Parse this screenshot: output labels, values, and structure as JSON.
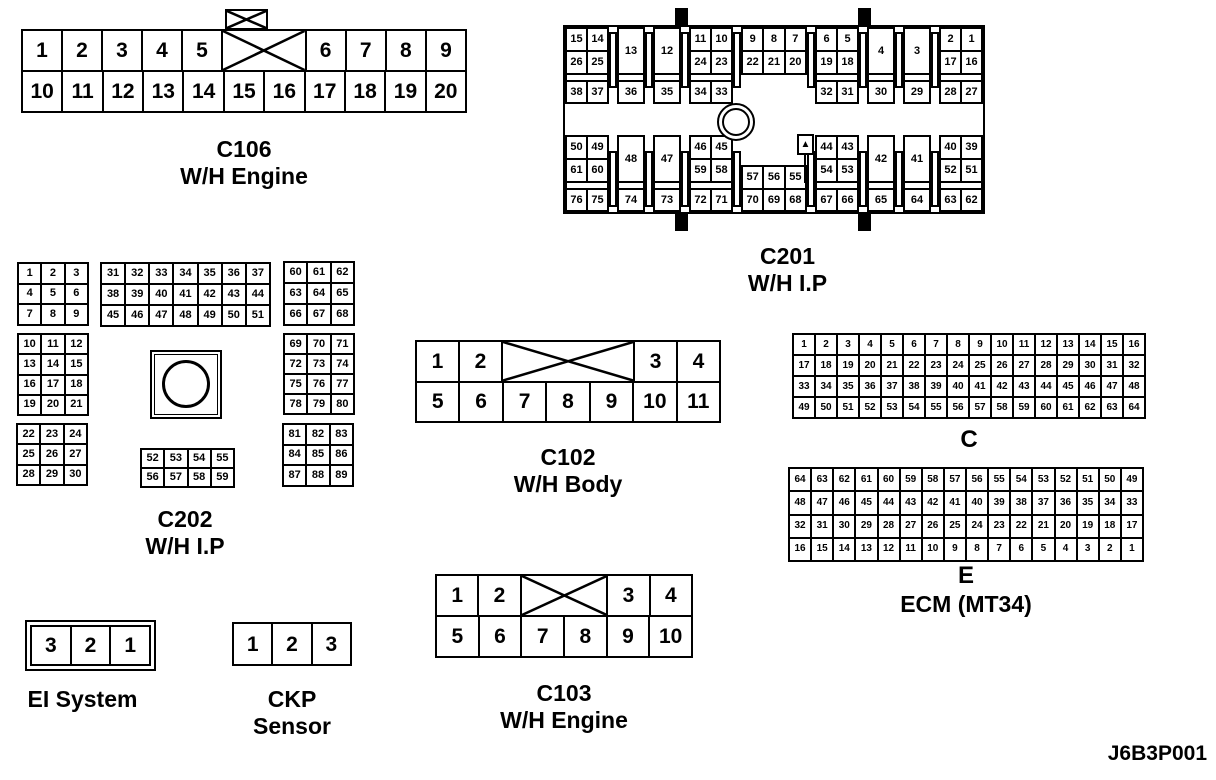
{
  "figure_code": "J6B3P001",
  "ecm_label": "ECM (MT34)",
  "connectors": {
    "c106": {
      "label": "C106",
      "sublabel": "W/H Engine",
      "row1_left": [
        "1",
        "2",
        "3",
        "4",
        "5"
      ],
      "row1_right": [
        "6",
        "7",
        "8",
        "9"
      ],
      "row2": [
        "10",
        "11",
        "12",
        "13",
        "14",
        "15",
        "16",
        "17",
        "18",
        "19",
        "20"
      ]
    },
    "c201": {
      "label": "C201",
      "sublabel": "W/H I.P",
      "marker": "▲",
      "top": {
        "p1": {
          "r1": [
            "15",
            "14"
          ],
          "r2": [
            "26",
            "25"
          ],
          "r3": [
            "38",
            "37"
          ]
        },
        "p2": {
          "top": "13",
          "bot": "36"
        },
        "p3": {
          "top": "12",
          "bot": "35"
        },
        "p4": {
          "r1": [
            "11",
            "10"
          ],
          "r2": [
            "24",
            "23"
          ],
          "r3": [
            "34",
            "33"
          ]
        },
        "p5": {
          "r1": [
            "9",
            "8",
            "7"
          ],
          "r2": [
            "22",
            "21",
            "20"
          ]
        },
        "p6": {
          "r1": [
            "6",
            "5"
          ],
          "r2": [
            "19",
            "18"
          ],
          "r3": [
            "32",
            "31"
          ]
        },
        "p7": {
          "top": "4",
          "bot": "30"
        },
        "p8": {
          "top": "3",
          "bot": "29"
        },
        "p9": {
          "r1": [
            "2",
            "1"
          ],
          "r2": [
            "17",
            "16"
          ],
          "r3": [
            "28",
            "27"
          ]
        }
      },
      "bottom": {
        "q1": {
          "r1": [
            "50",
            "49"
          ],
          "r2": [
            "61",
            "60"
          ],
          "r3": [
            "76",
            "75"
          ]
        },
        "q2": {
          "top": "48",
          "bot": "74"
        },
        "q3": {
          "top": "47",
          "bot": "73"
        },
        "q4": {
          "r1": [
            "46",
            "45"
          ],
          "r2": [
            "59",
            "58"
          ],
          "r3": [
            "72",
            "71"
          ]
        },
        "q5": {
          "r1": [
            "57",
            "56",
            "55"
          ],
          "r2": [
            "70",
            "69",
            "68"
          ]
        },
        "q6": {
          "r1": [
            "44",
            "43"
          ],
          "r2": [
            "54",
            "53"
          ],
          "r3": [
            "67",
            "66"
          ]
        },
        "q7": {
          "top": "42",
          "bot": "65"
        },
        "q8": {
          "top": "41",
          "bot": "64"
        },
        "q9": {
          "r1": [
            "40",
            "39"
          ],
          "r2": [
            "52",
            "51"
          ],
          "r3": [
            "63",
            "62"
          ]
        }
      }
    },
    "c202": {
      "label": "C202",
      "sublabel": "W/H I.P",
      "g1": [
        [
          "1",
          "2",
          "3"
        ],
        [
          "4",
          "5",
          "6"
        ],
        [
          "7",
          "8",
          "9"
        ]
      ],
      "g2": [
        [
          "31",
          "32",
          "33",
          "34",
          "35",
          "36",
          "37"
        ],
        [
          "38",
          "39",
          "40",
          "41",
          "42",
          "43",
          "44"
        ],
        [
          "45",
          "46",
          "47",
          "48",
          "49",
          "50",
          "51"
        ]
      ],
      "g3": [
        [
          "60",
          "61",
          "62"
        ],
        [
          "63",
          "64",
          "65"
        ],
        [
          "66",
          "67",
          "68"
        ]
      ],
      "g4": [
        [
          "10",
          "11",
          "12"
        ],
        [
          "13",
          "14",
          "15"
        ],
        [
          "16",
          "17",
          "18"
        ],
        [
          "19",
          "20",
          "21"
        ]
      ],
      "g5": [
        [
          "69",
          "70",
          "71"
        ],
        [
          "72",
          "73",
          "74"
        ],
        [
          "75",
          "76",
          "77"
        ],
        [
          "78",
          "79",
          "80"
        ]
      ],
      "g6": [
        [
          "22",
          "23",
          "24"
        ],
        [
          "25",
          "26",
          "27"
        ],
        [
          "28",
          "29",
          "30"
        ]
      ],
      "g7": [
        [
          "52",
          "53",
          "54",
          "55"
        ],
        [
          "56",
          "57",
          "58",
          "59"
        ]
      ],
      "g8": [
        [
          "81",
          "82",
          "83"
        ],
        [
          "84",
          "85",
          "86"
        ],
        [
          "87",
          "88",
          "89"
        ]
      ]
    },
    "c102": {
      "label": "C102",
      "sublabel": "W/H Body",
      "row1_left": [
        "1",
        "2"
      ],
      "row1_right": [
        "3",
        "4"
      ],
      "row2": [
        "5",
        "6",
        "7",
        "8",
        "9",
        "10",
        "11"
      ]
    },
    "c103": {
      "label": "C103",
      "sublabel": "W/H Engine",
      "row1_left": [
        "1",
        "2"
      ],
      "row1_right": [
        "3",
        "4"
      ],
      "row2": [
        "5",
        "6",
        "7",
        "8",
        "9",
        "10"
      ]
    },
    "ei_system": {
      "label": "EI System",
      "cells": [
        "3",
        "2",
        "1"
      ]
    },
    "ckp_sensor": {
      "label": "CKP",
      "label2": "Sensor",
      "cells": [
        "1",
        "2",
        "3"
      ]
    },
    "ecm_c": {
      "label": "C",
      "rows": [
        [
          "1",
          "2",
          "3",
          "4",
          "5",
          "6",
          "7",
          "8",
          "9",
          "10",
          "11",
          "12",
          "13",
          "14",
          "15",
          "16"
        ],
        [
          "17",
          "18",
          "19",
          "20",
          "21",
          "22",
          "23",
          "24",
          "25",
          "26",
          "27",
          "28",
          "29",
          "30",
          "31",
          "32"
        ],
        [
          "33",
          "34",
          "35",
          "36",
          "37",
          "38",
          "39",
          "40",
          "41",
          "42",
          "43",
          "44",
          "45",
          "46",
          "47",
          "48"
        ],
        [
          "49",
          "50",
          "51",
          "52",
          "53",
          "54",
          "55",
          "56",
          "57",
          "58",
          "59",
          "60",
          "61",
          "62",
          "63",
          "64"
        ]
      ]
    },
    "ecm_e": {
      "label": "E",
      "rows": [
        [
          "64",
          "63",
          "62",
          "61",
          "60",
          "59",
          "58",
          "57",
          "56",
          "55",
          "54",
          "53",
          "52",
          "51",
          "50",
          "49"
        ],
        [
          "48",
          "47",
          "46",
          "45",
          "44",
          "43",
          "42",
          "41",
          "40",
          "39",
          "38",
          "37",
          "36",
          "35",
          "34",
          "33"
        ],
        [
          "32",
          "31",
          "30",
          "29",
          "28",
          "27",
          "26",
          "25",
          "24",
          "23",
          "22",
          "21",
          "20",
          "19",
          "18",
          "17"
        ],
        [
          "16",
          "15",
          "14",
          "13",
          "12",
          "11",
          "10",
          "9",
          "8",
          "7",
          "6",
          "5",
          "4",
          "3",
          "2",
          "1"
        ]
      ]
    }
  }
}
